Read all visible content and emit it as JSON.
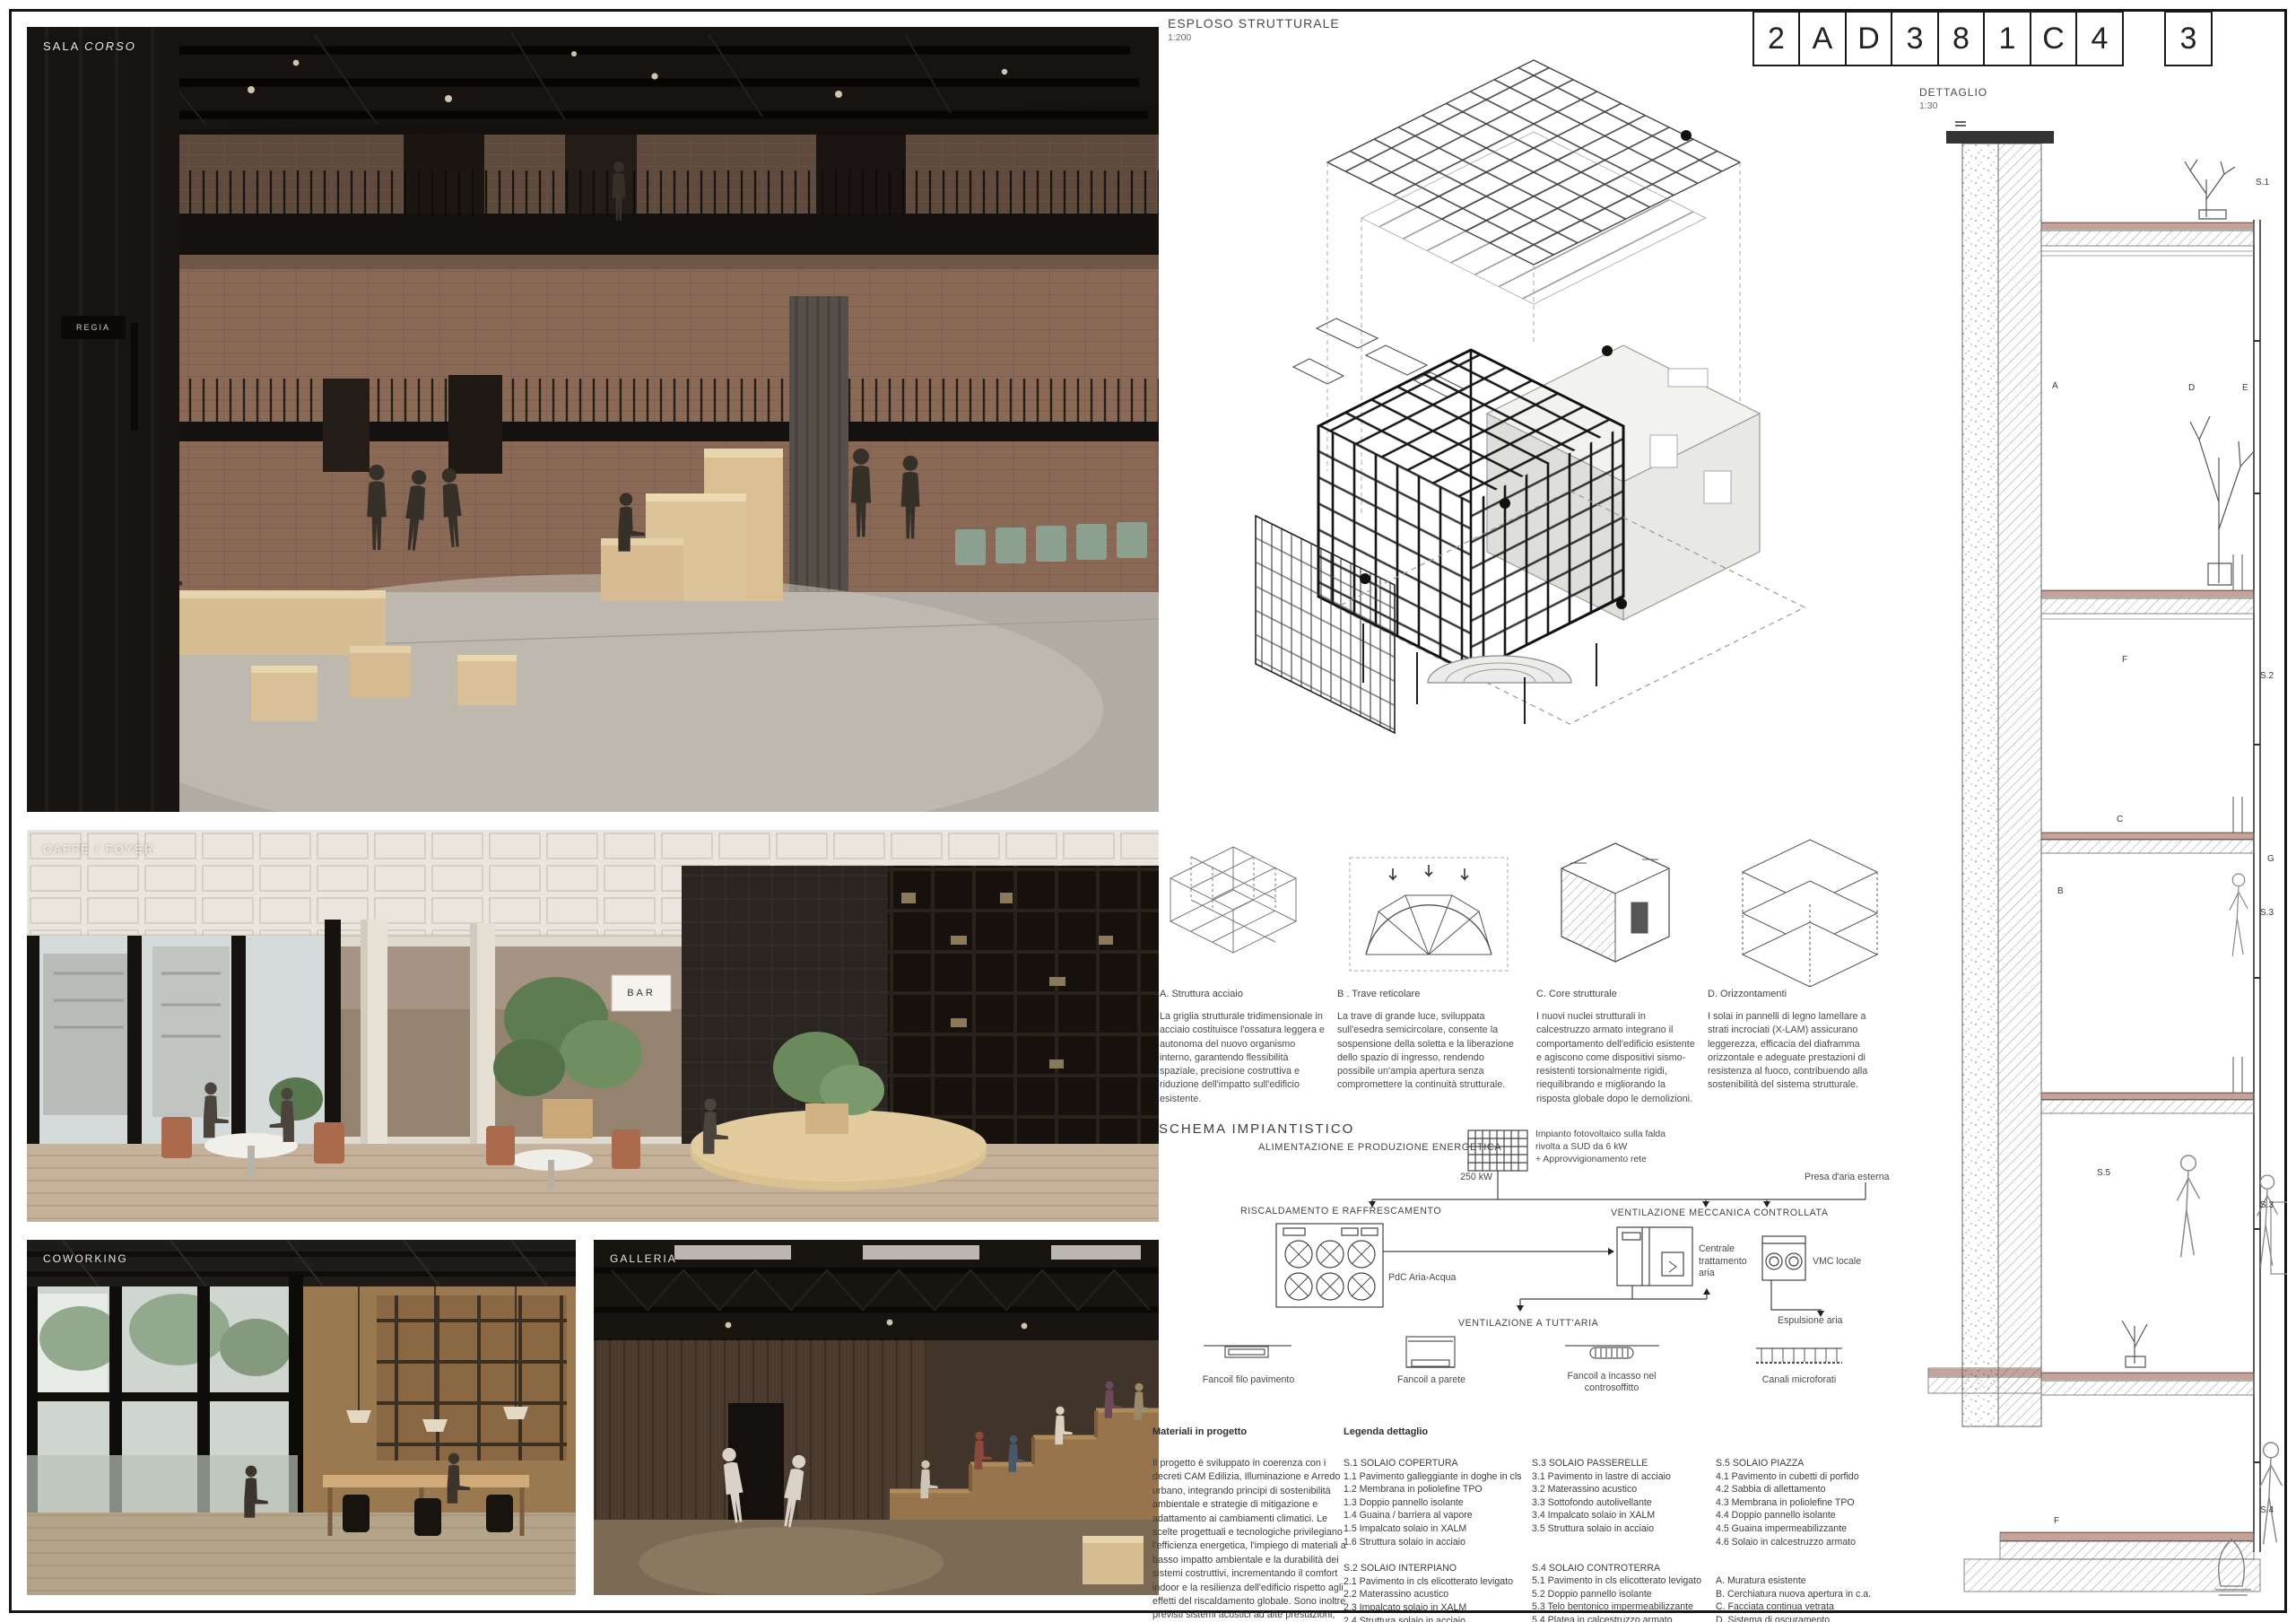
{
  "header": {
    "esploso_title": "ESPLOSO STRUTTURALE",
    "esploso_scale": "1:200",
    "dettaglio_title": "DETTAGLIO",
    "dettaglio_scale": "1:30",
    "code_cells": [
      "2",
      "A",
      "D",
      "3",
      "8",
      "1",
      "C",
      "4"
    ],
    "code_last": "3"
  },
  "renders": {
    "sala": {
      "label": "SALA ",
      "label_em": "CORSO",
      "sign": "REGIA"
    },
    "caffe": {
      "label": "CAFFÈ / FOYER",
      "bar_sign": "BAR"
    },
    "coworking": {
      "label": "COWORKING"
    },
    "galleria": {
      "label": "GALLERIA"
    }
  },
  "structure_notes": [
    {
      "label": "A. Struttura acciaio",
      "text": "La griglia strutturale tridimensionale in acciaio costituisce l'ossatura leggera e autonoma del nuovo organismo interno, garantendo flessibilità spaziale, precisione costruttiva e riduzione dell'impatto sull'edificio esistente."
    },
    {
      "label": "B . Trave reticolare",
      "text": "La trave di grande luce, sviluppata sull'esedra semicircolare, consente la sospensione della soletta e la liberazione dello spazio di ingresso, rendendo possibile un'ampia apertura senza compromettere la continuità strutturale."
    },
    {
      "label": "C. Core strutturale",
      "text": "I nuovi nuclei strutturali in calcestruzzo armato integrano il comportamento dell'edificio esistente e agiscono come dispositivi sismo-resistenti torsionalmente rigidi, riequilibrando e migliorando la risposta globale dopo le demolizioni."
    },
    {
      "label": "D. Orizzontamenti",
      "text": "I solai in pannelli di legno lamellare a strati incrociati (X-LAM) assicurano leggerezza, efficacia del diaframma orizzontale e adeguate prestazioni di resistenza al fuoco, contribuendo alla sostenibilità del sistema strutturale."
    }
  ],
  "schema": {
    "title": "SCHEMA IMPIANTISTICO",
    "alimentazione": "ALIMENTAZIONE E PRODUZIONE ENERGETICA",
    "pv_note": "Impianto fotovoltaico sulla falda\nrivolta a SUD da 6 kW\n+ Approvvigionamento rete",
    "power": "250 kW",
    "presa": "Presa d'aria esterna",
    "riscaldamento": "RISCALDAMENTO E RAFFRESCAMENTO",
    "vmc_title": "VENTILAZIONE MECCANICA CONTROLLATA",
    "pdc": "PdC Aria-Acqua",
    "centrale": "Centrale\ntrattamento\naria",
    "vmc_locale": "VMC locale",
    "espulsione": "Espulsione aria",
    "tuttaria": "VENTILAZIONE A TUTT'ARIA",
    "terminal_1": "Fancoil filo pavimento",
    "terminal_2": "Fancoil a parete",
    "terminal_3": "Fancoil a incasso nel\ncontrosoffitto",
    "terminal_4": "Canali microforati"
  },
  "materiali": {
    "title": "Materiali in progetto",
    "text": "Il progetto è sviluppato in coerenza con i decreti CAM Edilizia, Illuminazione e Arredo urbano, integrando principi di sostenibilità ambientale e strategie di mitigazione e adattamento ai cambiamenti climatici. Le scelte progettuali e tecnologiche privilegiano l'efficienza energetica, l'impiego di materiali a basso impatto ambientale e la durabilità dei sistemi costruttivi, incrementando il comfort indoor e la resilienza dell'edificio rispetto agli effetti del riscaldamento globale. Sono inoltre previsti sistemi acustici ad alte prestazioni, orientati al miglioramento dell'isolamento e dell'assorbimento sonoro, a beneficio del benessere e della qualità degli spazi."
  },
  "legenda": {
    "title": "Legenda dettaglio",
    "g1h": "S.1 SOLAIO COPERTURA",
    "g1": [
      "1.1 Pavimento galleggiante in doghe in cls",
      "1.2 Membrana in poliolefine TPO",
      "1.3 Doppio pannello isolante",
      "1.4 Guaina / barriera al vapore",
      "1.5 Impalcato solaio in XALM",
      "1.6 Struttura solaio in acciaio"
    ],
    "g2h": "S.2 SOLAIO INTERPIANO",
    "g2": [
      "2.1 Pavimento in cls elicotterato levigato",
      "2.2 Materassino acustico",
      "2.3 Impalcato solaio in XALM",
      "2.4 Struttura solaio in acciaio",
      "2.5 Pannello acustico in lana minerale",
      "2.5 Pannello in fibra di legno mineralizzata"
    ],
    "g3h": "S.3 SOLAIO PASSERELLE",
    "g3": [
      "3.1 Pavimento in lastre di acciaio",
      "3.2 Materassino acustico",
      "3.3 Sottofondo autolivellante",
      "3.4 Impalcato solaio in XALM",
      "3.5 Struttura solaio in acciaio"
    ],
    "g4h": "S.4 SOLAIO CONTROTERRA",
    "g4": [
      "5.1 Pavimento in cls elicotterato levigato",
      "5.2 Doppio pannello isolante",
      "5.3 Telo bentonico impermeabilizzante",
      "5.4 Platea in calcestruzzo armato",
      "5.5 Magrone",
      "5.6 Terreno esistente"
    ],
    "g5h": "S.5 SOLAIO PIAZZA",
    "g5": [
      "4.1 Pavimento in cubetti di porfido",
      "4.2 Sabbia di allettamento",
      "4.3 Membrana in poliolefine TPO",
      "4.4 Doppio pannello isolante",
      "4.5 Guaina impermeabilizzante",
      "4.6 Solaio in calcestruzzo armato"
    ],
    "g6": [
      "A. Muratura esistente",
      "B. Cerchiatura nuova apertura in c.a.",
      "C. Facciata continua vetrata",
      "D. Sistema di oscuramento",
      "E. Corpi illuminanti LED dimmerabili",
      "F. Fancoil a pavimento",
      "G. Parapetti passerelle in acciaio"
    ]
  },
  "detail_markers": [
    "S.1",
    "A",
    "D",
    "E",
    "F",
    "S.2",
    "C",
    "G",
    "B",
    "S.3",
    "S.5",
    "S.3",
    "F",
    "S.4"
  ]
}
